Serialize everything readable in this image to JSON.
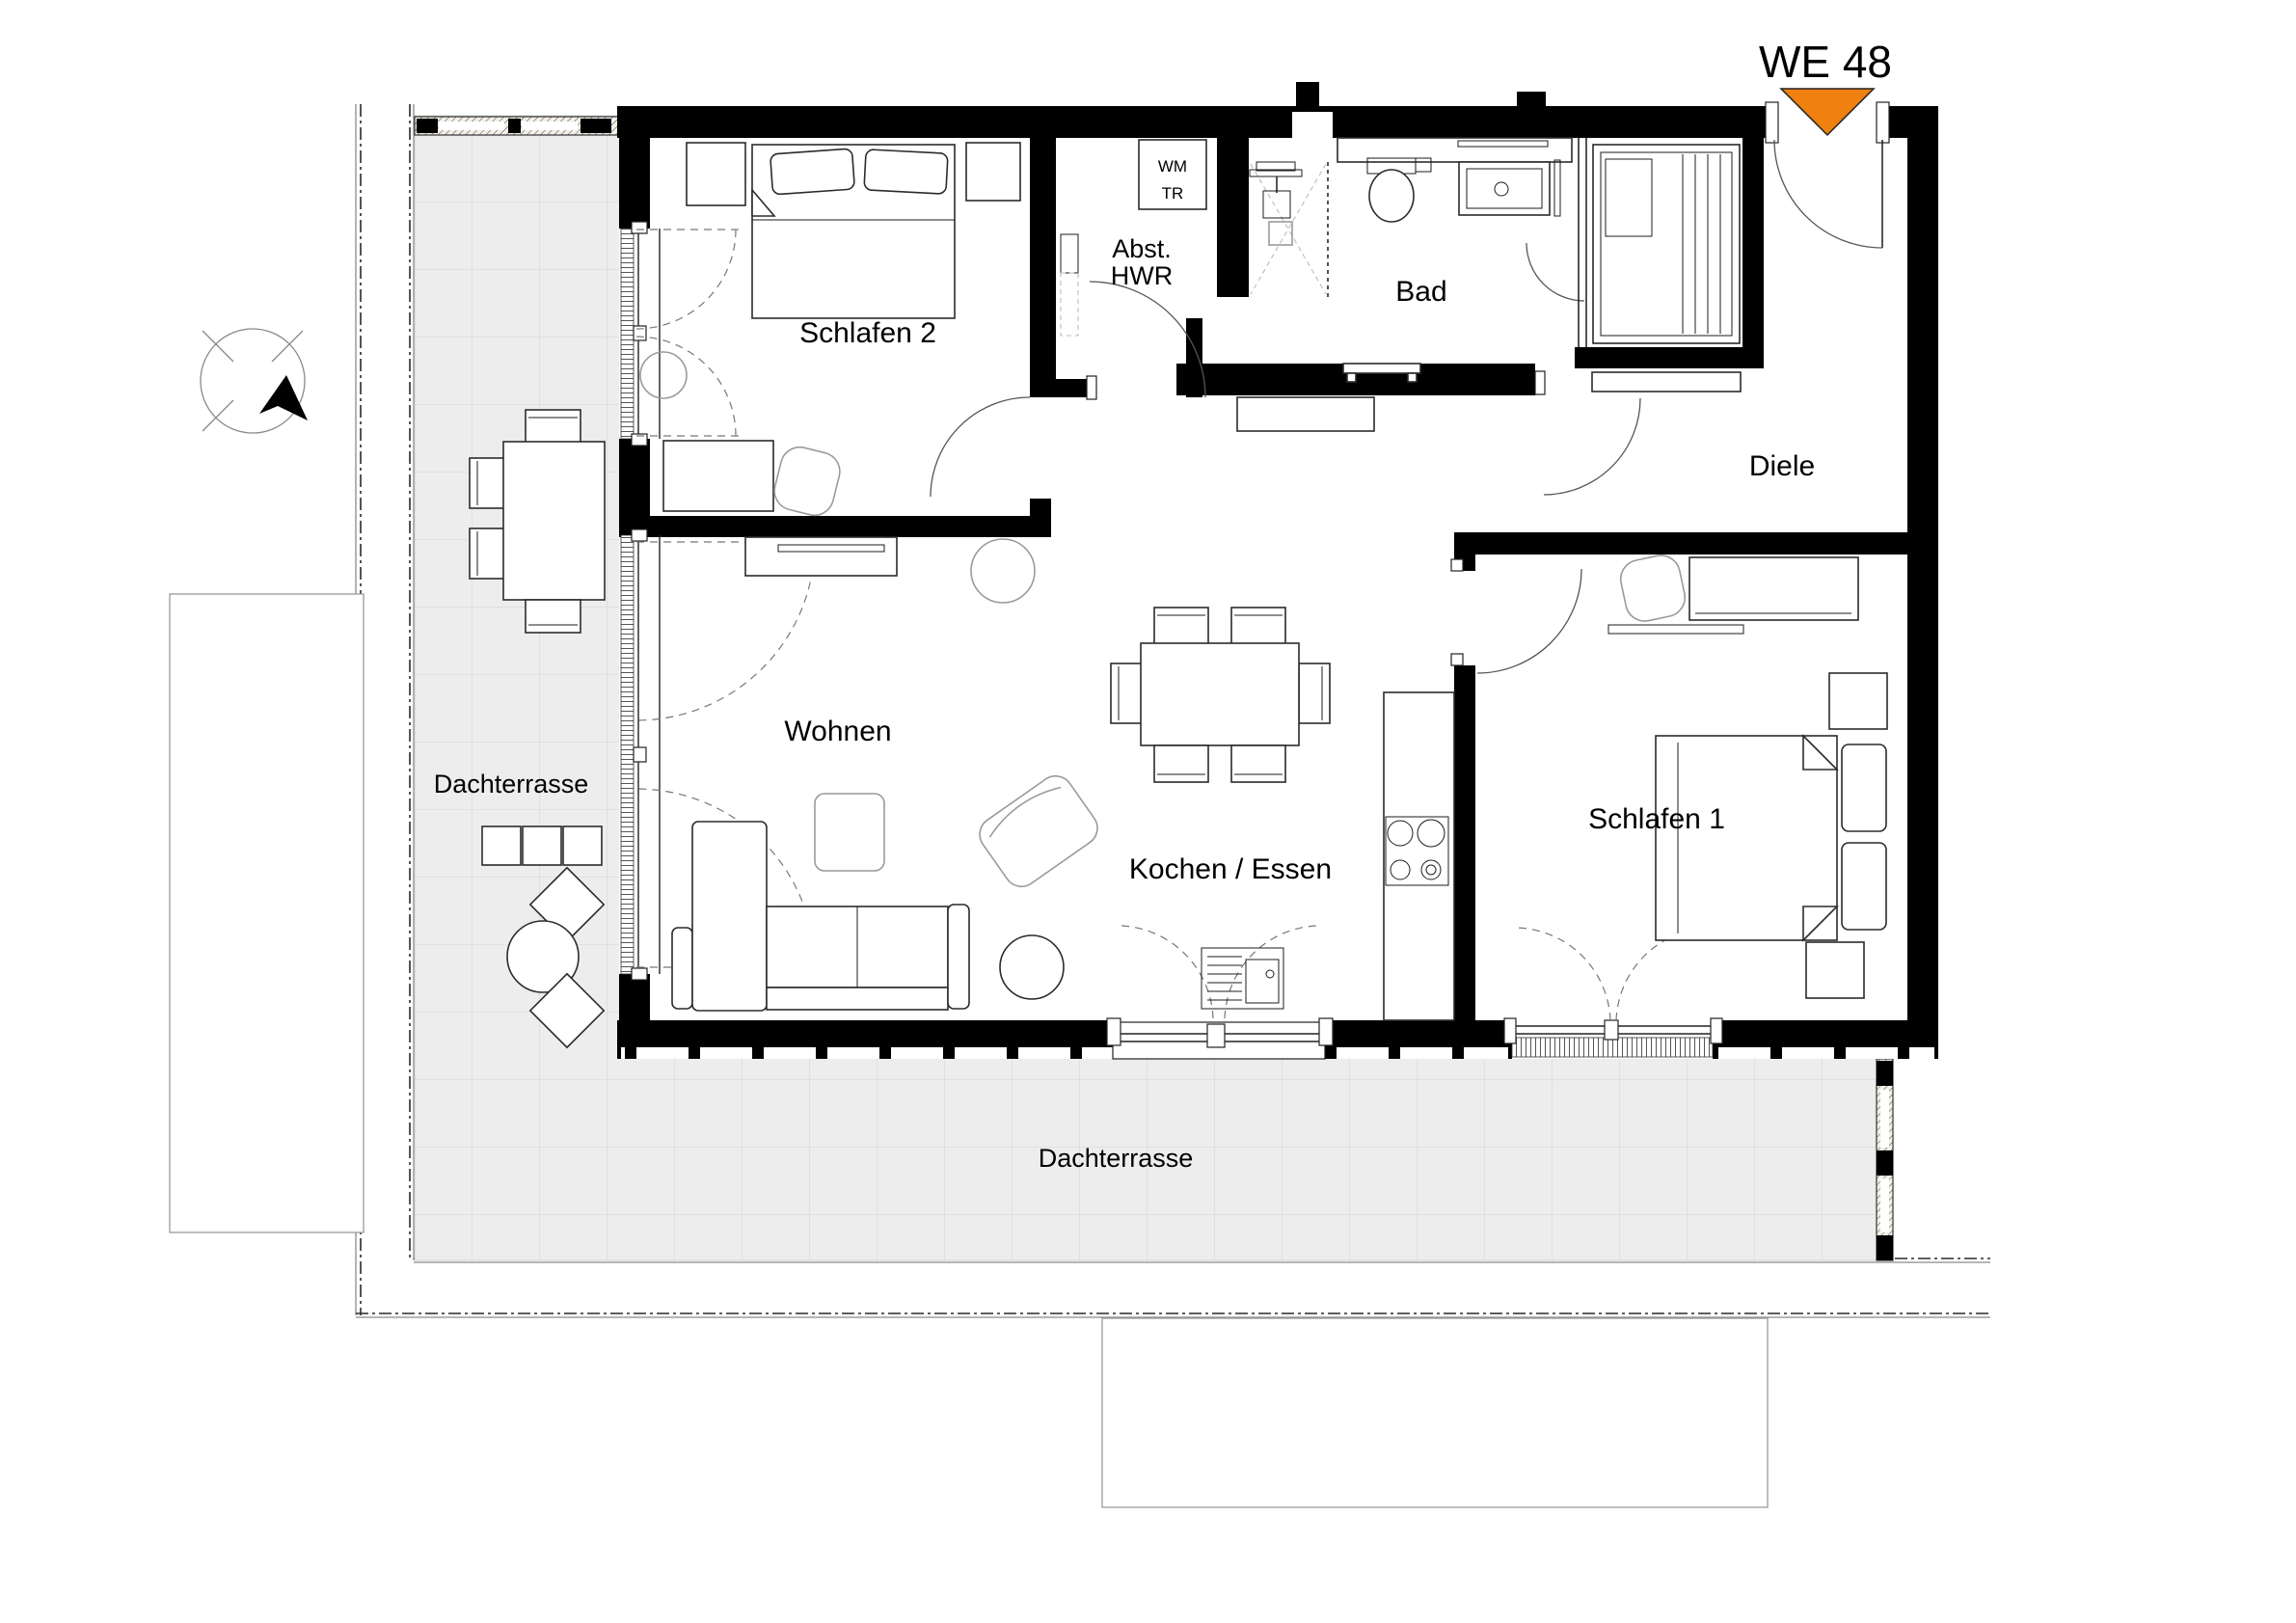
{
  "plan": {
    "unit_label": "WE 48",
    "rooms": {
      "schlafen2": "Schlafen 2",
      "abst_line1": "Abst.",
      "abst_line2": "HWR",
      "bad": "Bad",
      "diele": "Diele",
      "wohnen": "Wohnen",
      "kochen_essen": "Kochen / Essen",
      "schlafen1": "Schlafen 1",
      "dachterrasse_left": "Dachterrasse",
      "dachterrasse_bottom": "Dachterrasse"
    },
    "appliances": {
      "wm": "WM",
      "tr": "TR"
    },
    "colors": {
      "entrance_marker": "#F0800F",
      "wall": "#000000",
      "terrace_tile": "#ededed",
      "terrace_grid": "#dcdcdc"
    }
  }
}
